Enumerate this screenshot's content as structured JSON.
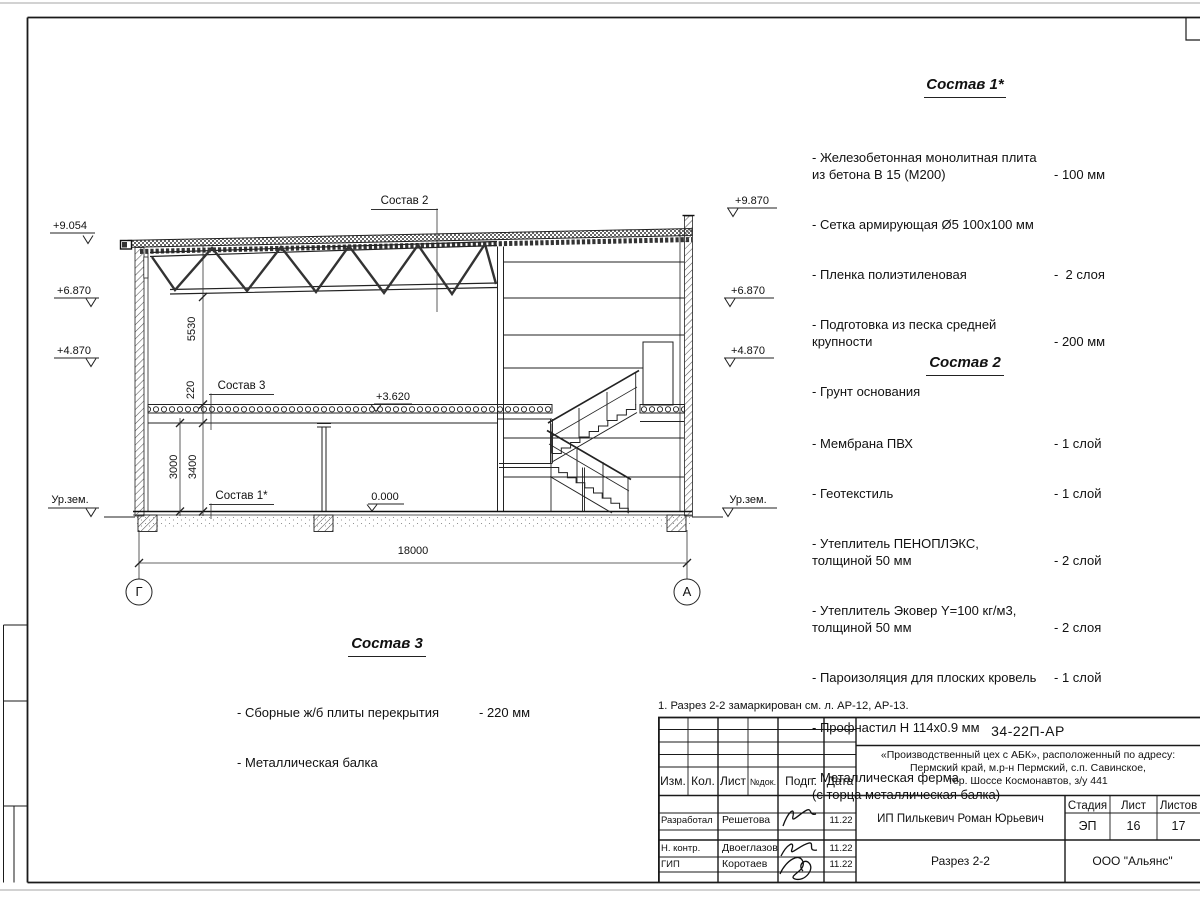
{
  "sheet": {
    "note": "1. Разрез 2-2 замаркирован см. л. АР-12, АР-13."
  },
  "lists": {
    "sostav1": {
      "title": "Состав 1*",
      "items": [
        {
          "text": "- Железобетонная  монолитная плита\nиз бетона В 15 (М200)",
          "value": "- 100 мм"
        },
        {
          "text": "- Сетка армирующая Ø5 100х100 мм",
          "value": ""
        },
        {
          "text": "- Пленка полиэтиленовая",
          "value": "-  2 слоя"
        },
        {
          "text": "- Подготовка из песка средней\nкрупности",
          "value": "- 200 мм"
        },
        {
          "text": "- Грунт основания",
          "value": ""
        }
      ]
    },
    "sostav2": {
      "title": "Состав 2",
      "items": [
        {
          "text": "- Мембрана ПВХ",
          "value": "- 1 слой"
        },
        {
          "text": "- Геотекстиль",
          "value": "- 1 слой"
        },
        {
          "text": "- Утеплитель ПЕНОПЛЭКС,\nтолщиной 50 мм",
          "value": "- 2 слой"
        },
        {
          "text": "- Утеплитель Эковер Y=100 кг/м3,\nтолщиной 50 мм",
          "value": "- 2 слоя"
        },
        {
          "text": "- Пароизоляция для плоских кровель",
          "value": "- 1 слой"
        },
        {
          "text": "- Профнастил Н 114х0.9 мм",
          "value": ""
        },
        {
          "text": "- Металлическая ферма\n(с торца металлическая балка)",
          "value": ""
        }
      ]
    },
    "sostav3": {
      "title": "Состав 3",
      "items": [
        {
          "text": "- Сборные ж/б  плиты перекрытия",
          "value": "- 220 мм"
        },
        {
          "text": "- Металлическая балка",
          "value": ""
        }
      ]
    }
  },
  "drawing": {
    "labels": {
      "ref_sostav2": "Состав 2",
      "ref_sostav3": "Состав 3",
      "ref_sostav1": "Состав 1*",
      "lvl_mid": "+3.620",
      "lvl_zero": "0.000"
    },
    "elev": {
      "l1": "+9.054",
      "l2": "+6.870",
      "l3": "+4.870",
      "l4": "Ур.зем.",
      "r1": "+9.870",
      "r2": "+6.870",
      "r3": "+4.870",
      "r4": "Ур.зем."
    },
    "dims": {
      "h_truss": "5530",
      "h_slab": "220",
      "h_beam": "3000",
      "h_floor": "3400",
      "w_span": "18000"
    },
    "axes": {
      "left": "Г",
      "right": "А"
    }
  },
  "titleblock": {
    "doc_number": "34-22П-АР",
    "project": "«Производственный цех с АБК», расположенный по адресу:\nПермский край, м.р-н Пермский, с.п. Савинское,\nтер. Шоссе Космонавтов, з/у 441",
    "client": "ИП Пилькевич Роман Юрьевич",
    "sheet_title": "Разрез 2-2",
    "company": "ООО \"Альянс\"",
    "stage_label": "Стадия",
    "sheet_label": "Лист",
    "sheets_label": "Листов",
    "stage": "ЭП",
    "sheet_no": "16",
    "sheets_total": "17",
    "cols": {
      "izm": "Изм.",
      "kol": "Кол.",
      "list": "Лист",
      "ndok": "№док.",
      "podp": "Подп.",
      "data": "Дата"
    },
    "rows": [
      {
        "role": "Разработал",
        "name": "Решетова",
        "date": "11.22"
      },
      {
        "role": "Н. контр.",
        "name": "Двоеглазов",
        "date": "11.22"
      },
      {
        "role": "ГИП",
        "name": "Коротаев",
        "date": "11.22"
      }
    ]
  }
}
